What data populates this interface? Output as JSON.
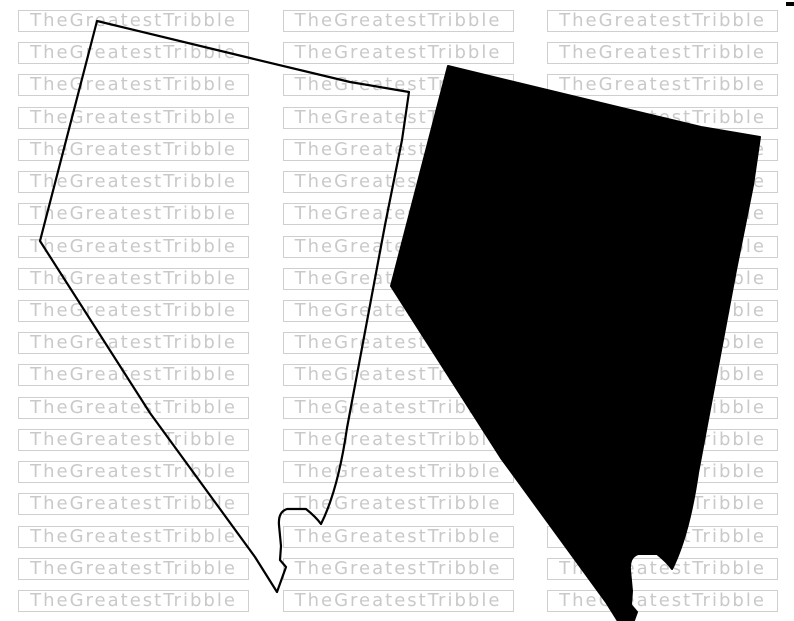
{
  "canvas": {
    "width": 794,
    "height": 621,
    "background": "#ffffff"
  },
  "watermark": {
    "text": "TheGreatestTribble",
    "rows": 19,
    "columns": 3,
    "text_color": "#c9c9c9",
    "border_color": "#cfcfcf"
  },
  "artwork": {
    "ink_color": "#000000",
    "shapes": [
      {
        "id": "nevada-outline-map",
        "style": "stroked outline, transparent fill"
      },
      {
        "id": "nevada-silhouette-map",
        "style": "solid black silhouette"
      }
    ]
  },
  "corner_mark": {
    "color": "#000000"
  }
}
